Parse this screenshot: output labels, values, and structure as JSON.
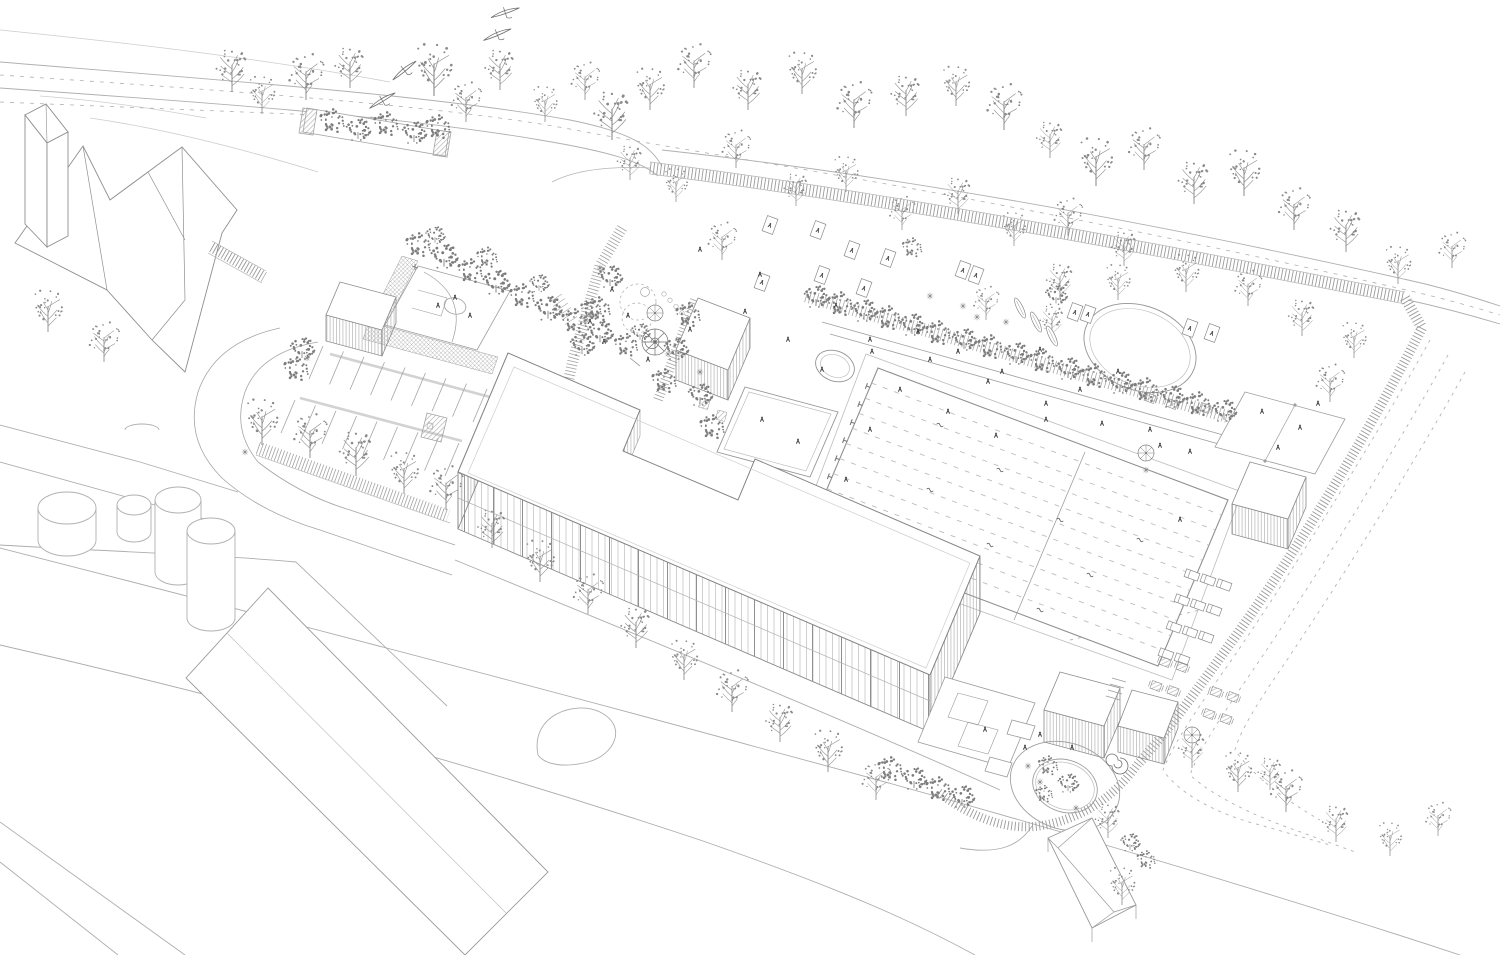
{
  "meta": {
    "title": "Axonometric site plan line drawing",
    "description": "Black-and-white architectural axonometric aerial drawing of a school campus with swimming pool, sports courts, playground, parking, roundabout, fences and many trees; church and industrial buildings at the edges."
  },
  "palette": {
    "background": "#ffffff",
    "line": "#9a9a9a",
    "line_light": "#c6c6c6",
    "line_dark": "#6f6f6f",
    "building_outline": "#858585",
    "vegetation": "#8a8a8a",
    "canopy": "#7c7c7c",
    "figure": "#3c3c3c",
    "water_lane": "#bdbdbd"
  },
  "scene": {
    "trees_bare": [
      [
        48,
        332,
        1.0
      ],
      [
        104,
        362,
        0.95
      ],
      [
        232,
        92,
        1.05
      ],
      [
        262,
        114,
        0.9
      ],
      [
        306,
        100,
        1.1
      ],
      [
        350,
        88,
        1.0
      ],
      [
        434,
        96,
        1.25
      ],
      [
        466,
        122,
        0.95
      ],
      [
        500,
        90,
        1.0
      ],
      [
        545,
        122,
        0.85
      ],
      [
        585,
        100,
        0.9
      ],
      [
        612,
        140,
        1.2
      ],
      [
        650,
        110,
        1.0
      ],
      [
        694,
        88,
        1.05
      ],
      [
        748,
        110,
        1.0
      ],
      [
        802,
        94,
        1.0
      ],
      [
        854,
        128,
        1.1
      ],
      [
        906,
        116,
        1.0
      ],
      [
        956,
        106,
        0.95
      ],
      [
        1004,
        130,
        1.1
      ],
      [
        1050,
        158,
        0.9
      ],
      [
        1096,
        186,
        1.15
      ],
      [
        1144,
        170,
        1.0
      ],
      [
        1194,
        204,
        1.05
      ],
      [
        1244,
        196,
        1.1
      ],
      [
        1294,
        230,
        1.0
      ],
      [
        1346,
        252,
        1.05
      ],
      [
        1398,
        284,
        0.9
      ],
      [
        1452,
        268,
        0.85
      ],
      [
        630,
        180,
        0.85
      ],
      [
        676,
        202,
        0.8
      ],
      [
        736,
        168,
        0.9
      ],
      [
        796,
        206,
        0.8
      ],
      [
        846,
        192,
        0.85
      ],
      [
        902,
        230,
        0.8
      ],
      [
        958,
        214,
        0.9
      ],
      [
        1014,
        246,
        0.8
      ],
      [
        1068,
        236,
        0.9
      ],
      [
        1124,
        266,
        0.85
      ],
      [
        1186,
        292,
        0.9
      ],
      [
        1248,
        306,
        0.85
      ],
      [
        1302,
        336,
        0.9
      ],
      [
        1354,
        358,
        0.85
      ],
      [
        1330,
        402,
        0.9
      ],
      [
        1060,
        300,
        0.9
      ],
      [
        1118,
        300,
        0.85
      ],
      [
        986,
        320,
        0.8
      ],
      [
        1052,
        338,
        0.8
      ],
      [
        262,
        445,
        1.1
      ],
      [
        310,
        458,
        1.05
      ],
      [
        356,
        476,
        1.1
      ],
      [
        404,
        494,
        1.0
      ],
      [
        446,
        510,
        1.05
      ],
      [
        492,
        548,
        0.95
      ],
      [
        540,
        582,
        1.0
      ],
      [
        588,
        614,
        0.95
      ],
      [
        636,
        648,
        1.0
      ],
      [
        684,
        680,
        0.95
      ],
      [
        732,
        712,
        1.0
      ],
      [
        780,
        742,
        0.95
      ],
      [
        828,
        772,
        1.0
      ],
      [
        876,
        800,
        0.9
      ],
      [
        1108,
        838,
        0.85
      ],
      [
        1122,
        905,
        0.9
      ],
      [
        722,
        260,
        0.9
      ],
      [
        1192,
        768,
        0.9
      ],
      [
        1238,
        792,
        0.95
      ],
      [
        1286,
        812,
        1.0
      ],
      [
        1336,
        842,
        0.9
      ],
      [
        1390,
        856,
        0.8
      ],
      [
        1438,
        836,
        0.8
      ],
      [
        1270,
        790,
        0.8
      ]
    ],
    "trees_round": [
      [
        418,
        248,
        1.0
      ],
      [
        444,
        260,
        1.1
      ],
      [
        470,
        274,
        1.0
      ],
      [
        496,
        286,
        1.1
      ],
      [
        522,
        299,
        1.0
      ],
      [
        548,
        312,
        1.1
      ],
      [
        574,
        324,
        1.0
      ],
      [
        600,
        336,
        1.05
      ],
      [
        626,
        348,
        0.95
      ],
      [
        435,
        238,
        0.8
      ],
      [
        487,
        260,
        0.85
      ],
      [
        539,
        286,
        0.8
      ],
      [
        591,
        312,
        0.85
      ],
      [
        640,
        335,
        0.8
      ],
      [
        332,
        124,
        0.55
      ],
      [
        358,
        133,
        0.6
      ],
      [
        386,
        127,
        0.55
      ],
      [
        414,
        136,
        0.6
      ],
      [
        438,
        130,
        0.55
      ],
      [
        302,
        352,
        0.65
      ],
      [
        296,
        372,
        0.55
      ],
      [
        610,
        280,
        0.65
      ],
      [
        598,
        312,
        0.6
      ],
      [
        582,
        348,
        0.65
      ],
      [
        688,
        318,
        0.6
      ],
      [
        676,
        352,
        0.65
      ],
      [
        664,
        384,
        0.6
      ],
      [
        700,
        398,
        0.65
      ],
      [
        712,
        430,
        0.55
      ],
      [
        816,
        300,
        0.62
      ],
      [
        840,
        307,
        0.68
      ],
      [
        864,
        314,
        0.62
      ],
      [
        888,
        321,
        0.68
      ],
      [
        912,
        328,
        0.62
      ],
      [
        938,
        336,
        0.64
      ],
      [
        964,
        343,
        0.68
      ],
      [
        990,
        350,
        0.62
      ],
      [
        1016,
        357,
        0.64
      ],
      [
        1042,
        364,
        0.62
      ],
      [
        1068,
        372,
        0.64
      ],
      [
        1094,
        379,
        0.62
      ],
      [
        1120,
        386,
        0.64
      ],
      [
        1146,
        393,
        0.62
      ],
      [
        1172,
        400,
        0.64
      ],
      [
        1198,
        407,
        0.62
      ],
      [
        1224,
        414,
        0.62
      ],
      [
        912,
        250,
        0.8
      ],
      [
        1056,
        298,
        0.9
      ],
      [
        890,
        772,
        0.62
      ],
      [
        914,
        782,
        0.62
      ],
      [
        938,
        792,
        0.62
      ],
      [
        962,
        800,
        0.62
      ],
      [
        1048,
        768,
        0.8
      ],
      [
        1068,
        786,
        0.85
      ],
      [
        1044,
        796,
        0.7
      ],
      [
        1130,
        845,
        0.8
      ],
      [
        1146,
        862,
        0.75
      ]
    ],
    "flowers": [
      [
        307,
        358
      ],
      [
        245,
        452
      ],
      [
        600,
        268
      ],
      [
        586,
        320
      ],
      [
        668,
        354
      ],
      [
        700,
        372
      ],
      [
        930,
        296
      ],
      [
        963,
        306
      ],
      [
        977,
        317
      ],
      [
        1006,
        322
      ],
      [
        1040,
        782
      ],
      [
        1076,
        808
      ],
      [
        1028,
        766
      ],
      [
        1146,
        470
      ]
    ],
    "figures": [
      [
        612,
        290
      ],
      [
        628,
        316
      ],
      [
        604,
        342
      ],
      [
        648,
        360
      ],
      [
        590,
        322
      ],
      [
        455,
        298
      ],
      [
        470,
        316
      ],
      [
        438,
        306
      ],
      [
        1262,
        412
      ],
      [
        1300,
        428
      ],
      [
        1278,
        448
      ],
      [
        1318,
        404
      ],
      [
        870,
        430
      ],
      [
        846,
        480
      ],
      [
        1180,
        520
      ],
      [
        700,
        250
      ],
      [
        745,
        312
      ],
      [
        788,
        340
      ],
      [
        836,
        306
      ],
      [
        872,
        352
      ],
      [
        918,
        332
      ],
      [
        958,
        352
      ],
      [
        1002,
        372
      ],
      [
        1040,
        350
      ],
      [
        1080,
        390
      ],
      [
        1118,
        372
      ],
      [
        900,
        390
      ],
      [
        948,
        412
      ],
      [
        996,
        436
      ],
      [
        1046,
        420
      ],
      [
        760,
        275
      ],
      [
        690,
        330
      ],
      [
        1150,
        430
      ],
      [
        1190,
        452
      ],
      [
        822,
        370
      ],
      [
        870,
        340
      ],
      [
        930,
        360
      ],
      [
        988,
        382
      ],
      [
        1046,
        404
      ],
      [
        1102,
        424
      ],
      [
        1160,
        446
      ],
      [
        762,
        420
      ],
      [
        798,
        442
      ],
      [
        985,
        730
      ],
      [
        1025,
        748
      ],
      [
        1072,
        748
      ],
      [
        1040,
        735
      ]
    ],
    "swimmers": [
      [
        940,
        425
      ],
      [
        1000,
        470
      ],
      [
        1060,
        520
      ],
      [
        930,
        490
      ],
      [
        990,
        545
      ],
      [
        1090,
        575
      ],
      [
        1140,
        540
      ],
      [
        1040,
        610
      ]
    ],
    "blankets": [
      [
        770,
        225
      ],
      [
        818,
        230
      ],
      [
        852,
        250
      ],
      [
        888,
        258
      ],
      [
        822,
        275
      ],
      [
        762,
        282
      ],
      [
        864,
        288
      ],
      [
        963,
        270
      ],
      [
        976,
        275
      ],
      [
        1075,
        312
      ],
      [
        1088,
        314
      ],
      [
        1190,
        328
      ],
      [
        1212,
        333
      ]
    ],
    "loungers": [
      [
        1192,
        575
      ],
      [
        1208,
        580
      ],
      [
        1224,
        585
      ],
      [
        1182,
        600
      ],
      [
        1198,
        605
      ],
      [
        1214,
        610
      ],
      [
        1174,
        627
      ],
      [
        1190,
        632
      ],
      [
        1206,
        637
      ],
      [
        1166,
        654
      ],
      [
        1182,
        659
      ]
    ],
    "tables": [
      [
        1165,
        662
      ],
      [
        1182,
        667
      ],
      [
        1156,
        686
      ],
      [
        1173,
        691
      ],
      [
        1216,
        692
      ],
      [
        1233,
        697
      ],
      [
        1209,
        714
      ],
      [
        1226,
        719
      ],
      [
        1150,
        398
      ],
      [
        1172,
        404
      ],
      [
        1205,
        408
      ]
    ],
    "parasols": [
      [
        1146,
        453
      ],
      [
        1192,
        735
      ],
      [
        655,
        313
      ]
    ],
    "canoes": [
      [
        1020,
        308,
        64
      ],
      [
        1036,
        322,
        64
      ],
      [
        1052,
        336,
        64
      ]
    ],
    "birds": [
      [
        505,
        12,
        -18
      ],
      [
        497,
        34,
        -22
      ],
      [
        404,
        70,
        -38
      ],
      [
        382,
        100,
        -30
      ]
    ],
    "pool": {
      "nw": [
        878,
        368
      ],
      "ne": [
        1228,
        500
      ],
      "sw": [
        808,
        534
      ],
      "lanes": 10,
      "blocks": 8
    },
    "parking_rows": [
      {
        "from": [
          323,
          346
        ],
        "to": [
          487,
          389
        ],
        "n": 9,
        "vec": [
          -14,
          33
        ]
      },
      {
        "from": [
          295,
          400
        ],
        "to": [
          459,
          443
        ],
        "n": 9,
        "vec": [
          -14,
          33
        ]
      }
    ],
    "playground_trail": {
      "from": [
        664,
        294
      ],
      "to": [
        706,
        338
      ],
      "n": 8
    }
  }
}
